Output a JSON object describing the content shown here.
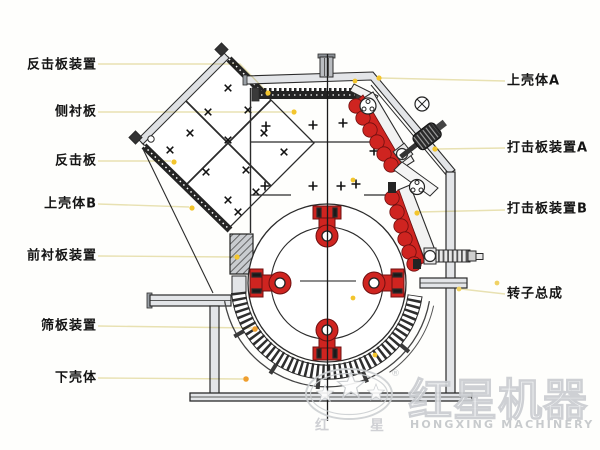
{
  "labels": {
    "left": [
      {
        "text": "反击板装置"
      },
      {
        "text": "侧衬板"
      },
      {
        "text": "反击板"
      },
      {
        "text": "上壳体B"
      },
      {
        "text": "前衬板装置"
      },
      {
        "text": "筛板装置"
      },
      {
        "text": "下壳体"
      }
    ],
    "right": [
      {
        "text": "上壳体A"
      },
      {
        "text": "打击板装置A"
      },
      {
        "text": "打击板装置B"
      },
      {
        "text": "转子总成"
      }
    ]
  },
  "watermark": {
    "brand_cn": "红星机器",
    "brand_en": "HONGXING MACHINERY",
    "seal_cn_left": "红",
    "seal_cn_right": "星",
    "registered_mark": "®"
  },
  "colors": {
    "part_red": "#cf2420",
    "leader_line": "#e9e2b4",
    "dot_yellow": "#f3c52d",
    "dot_orange": "#ef9f2f",
    "drawing_line": "#2b2b2b"
  }
}
